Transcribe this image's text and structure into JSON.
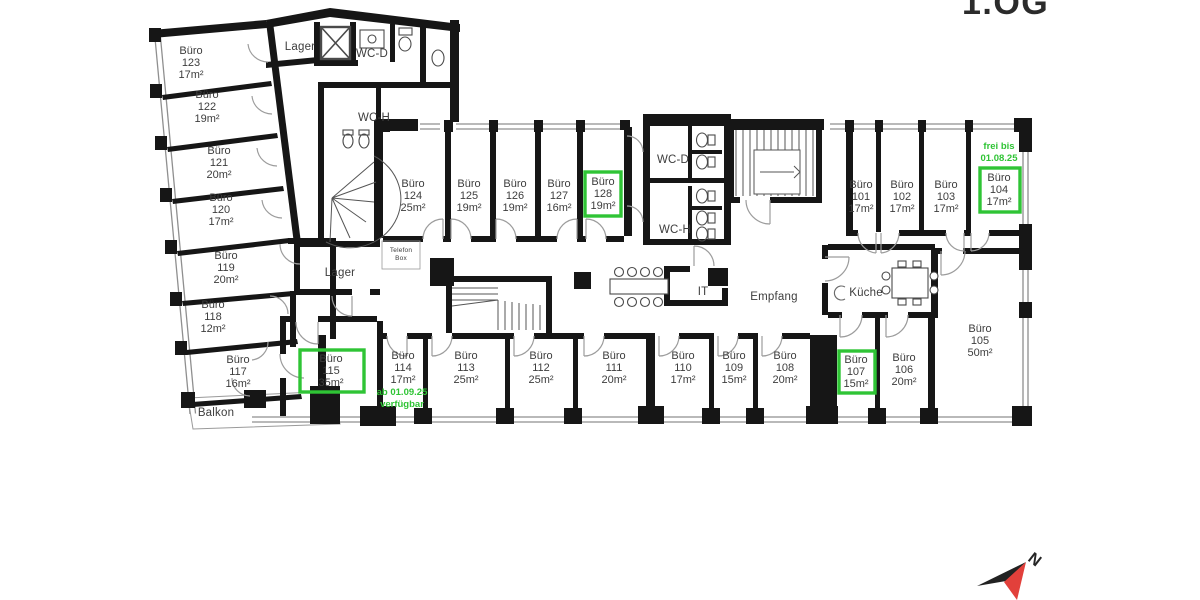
{
  "floor": {
    "title": "1.OG"
  },
  "colors": {
    "available_green": "#2fc435",
    "wall": "#161616",
    "label": "#3d3d3d",
    "compass_red": "#e2403b",
    "door_arc": "#9c9c9c",
    "window_gray": "#8f8f8f"
  },
  "rooms": [
    {
      "name": "Büro",
      "number": "123",
      "size": "17m²",
      "available": false
    },
    {
      "name": "Büro",
      "number": "122",
      "size": "19m²",
      "available": false
    },
    {
      "name": "Büro",
      "number": "121",
      "size": "20m²",
      "available": false
    },
    {
      "name": "Büro",
      "number": "120",
      "size": "17m²",
      "available": false
    },
    {
      "name": "Büro",
      "number": "119",
      "size": "20m²",
      "available": false
    },
    {
      "name": "Büro",
      "number": "118",
      "size": "12m²",
      "available": false
    },
    {
      "name": "Büro",
      "number": "117",
      "size": "16m²",
      "available": false
    },
    {
      "name": "Büro",
      "number": "124",
      "size": "25m²",
      "available": false
    },
    {
      "name": "Büro",
      "number": "125",
      "size": "19m²",
      "available": false
    },
    {
      "name": "Büro",
      "number": "126",
      "size": "19m²",
      "available": false
    },
    {
      "name": "Büro",
      "number": "127",
      "size": "16m²",
      "available": false
    },
    {
      "name": "Büro",
      "number": "128",
      "size": "19m²",
      "available": true
    },
    {
      "name": "Büro",
      "number": "101",
      "size": "17m²",
      "available": false
    },
    {
      "name": "Büro",
      "number": "102",
      "size": "17m²",
      "available": false
    },
    {
      "name": "Büro",
      "number": "103",
      "size": "17m²",
      "available": false
    },
    {
      "name": "Büro",
      "number": "104",
      "size": "17m²",
      "available": true
    },
    {
      "name": "Büro",
      "number": "115",
      "size": "35m²",
      "available": true
    },
    {
      "name": "Büro",
      "number": "114",
      "size": "17m²",
      "available": false
    },
    {
      "name": "Büro",
      "number": "113",
      "size": "25m²",
      "available": false
    },
    {
      "name": "Büro",
      "number": "112",
      "size": "25m²",
      "available": false
    },
    {
      "name": "Büro",
      "number": "111",
      "size": "20m²",
      "available": false
    },
    {
      "name": "Büro",
      "number": "110",
      "size": "17m²",
      "available": false
    },
    {
      "name": "Büro",
      "number": "109",
      "size": "15m²",
      "available": false
    },
    {
      "name": "Büro",
      "number": "108",
      "size": "20m²",
      "available": false
    },
    {
      "name": "Büro",
      "number": "107",
      "size": "15m²",
      "available": true
    },
    {
      "name": "Büro",
      "number": "106",
      "size": "20m²",
      "available": false
    },
    {
      "name": "Büro",
      "number": "105",
      "size": "50m²",
      "available": false
    }
  ],
  "areas": {
    "lager_top": "Lager",
    "wc_d_top": "WC-D",
    "wc_h_top": "WC-H",
    "lager_mid": "Lager",
    "telefon_line1": "Telefon",
    "telefon_line2": "Box",
    "wc_d_mid": "WC-D",
    "wc_h_mid": "WC-H",
    "it": "IT",
    "empfang": "Empfang",
    "kueche": "Küche",
    "balkon": "Balkon"
  },
  "notes": [
    {
      "room": "104",
      "line1": "frei bis",
      "line2": "01.08.25"
    },
    {
      "room": "114",
      "line1": "ab 01.09.25",
      "line2": "verfügbar"
    }
  ],
  "compass": {
    "label": "N"
  }
}
